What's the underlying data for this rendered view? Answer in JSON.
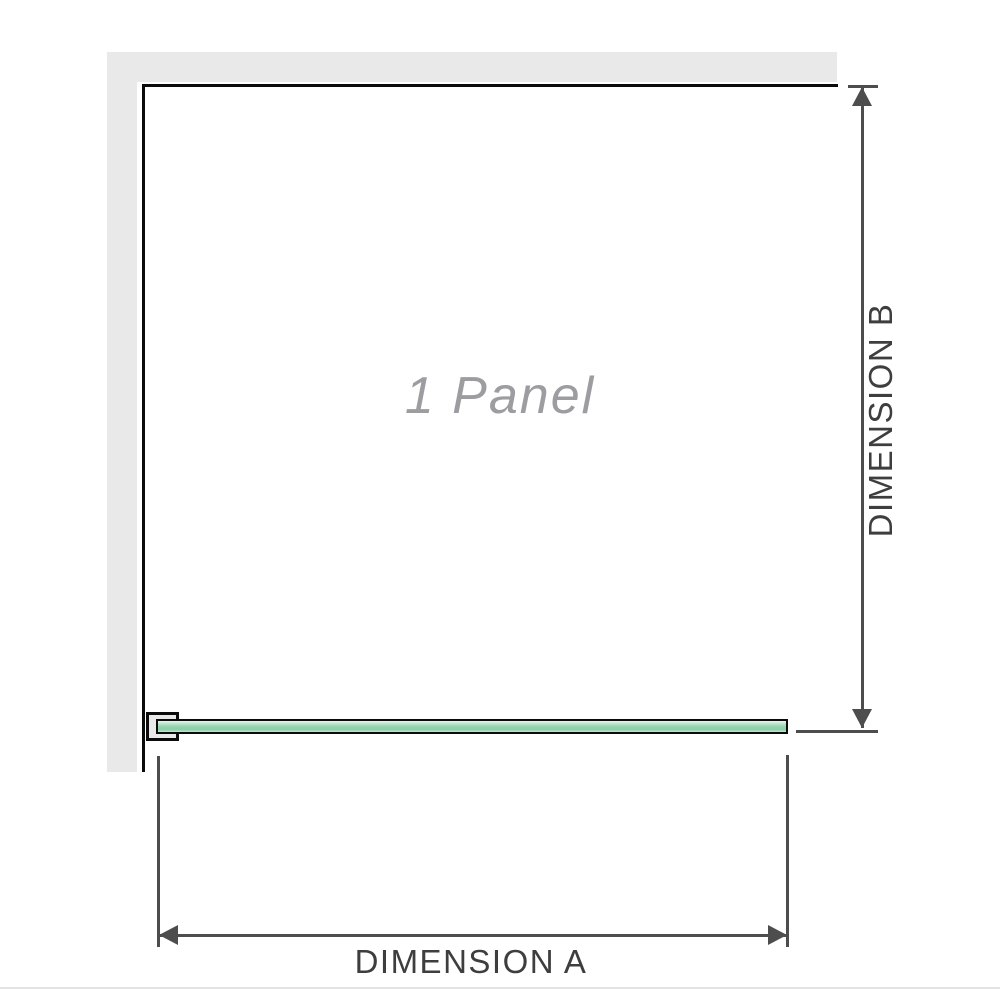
{
  "diagram": {
    "panel_label": "1 Panel",
    "dimension_a_label": "DIMENSION A",
    "dimension_b_label": "DIMENSION B"
  },
  "colors": {
    "wall_fill": "#e9e9ea",
    "panel_border": "#0b0b0b",
    "dimension_line": "#4d4d4d",
    "label_text": "#3e3e3e",
    "panel_label_text": "#9d9da1",
    "glass_light": "#e9f6ee",
    "glass_soft": "#b5e2c8",
    "glass_mid": "#92d2ae",
    "glass_deep": "#8ccfa8",
    "glass_edge": "#c2e8d2",
    "footer_line": "#e4e2e2"
  }
}
